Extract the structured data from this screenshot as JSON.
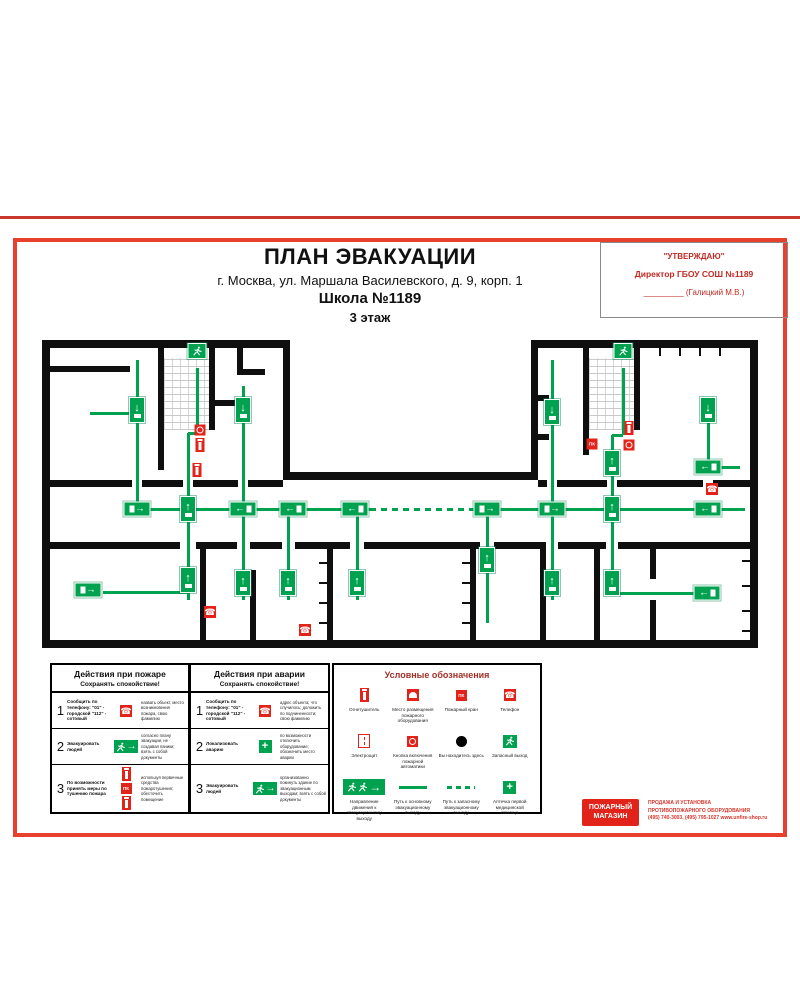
{
  "header": {
    "title": "ПЛАН ЭВАКУАЦИИ",
    "address": "г. Москва, ул. Маршала Василевского, д. 9, корп. 1",
    "building": "Школа №1189",
    "floor": "3 этаж"
  },
  "approval": {
    "line1": "\"УТВЕРЖДАЮ\"",
    "line2": "Директор ГБОУ СОШ №1189",
    "line3": "_________ (Галицкий М.В.)"
  },
  "plan": {
    "wall_color": "#0f0f0f",
    "route_color": "#00a14f",
    "alarm_color": "#e2231a",
    "walls": [
      [
        42,
        340,
        248,
        8
      ],
      [
        531,
        340,
        227,
        8
      ],
      [
        42,
        340,
        8,
        308
      ],
      [
        750,
        340,
        8,
        308
      ],
      [
        42,
        640,
        716,
        8
      ],
      [
        283,
        340,
        7,
        140
      ],
      [
        531,
        340,
        7,
        140
      ],
      [
        283,
        472,
        255,
        8
      ],
      [
        49,
        480,
        83,
        7
      ],
      [
        142,
        480,
        41,
        7
      ],
      [
        193,
        480,
        45,
        7
      ],
      [
        248,
        480,
        35,
        7
      ],
      [
        538,
        480,
        9,
        7
      ],
      [
        557,
        480,
        50,
        7
      ],
      [
        617,
        480,
        86,
        7
      ],
      [
        713,
        480,
        37,
        7
      ],
      [
        49,
        542,
        131,
        7
      ],
      [
        196,
        542,
        41,
        7
      ],
      [
        250,
        542,
        32,
        7
      ],
      [
        295,
        542,
        55,
        7
      ],
      [
        364,
        542,
        116,
        7
      ],
      [
        494,
        542,
        52,
        7
      ],
      [
        558,
        542,
        48,
        7
      ],
      [
        618,
        542,
        132,
        7
      ],
      [
        158,
        348,
        6,
        122
      ],
      [
        209,
        348,
        6,
        82
      ],
      [
        49,
        366,
        81,
        6
      ],
      [
        237,
        348,
        6,
        27
      ],
      [
        237,
        369,
        28,
        6
      ],
      [
        209,
        400,
        36,
        6
      ],
      [
        583,
        348,
        6,
        107
      ],
      [
        634,
        348,
        6,
        82
      ],
      [
        538,
        395,
        11,
        6
      ],
      [
        538,
        434,
        11,
        6
      ],
      [
        200,
        549,
        6,
        91
      ],
      [
        250,
        570,
        6,
        78
      ],
      [
        327,
        549,
        6,
        91
      ],
      [
        470,
        549,
        6,
        91
      ],
      [
        540,
        549,
        6,
        91
      ],
      [
        594,
        549,
        6,
        91
      ],
      [
        650,
        549,
        6,
        30
      ],
      [
        650,
        600,
        6,
        40
      ]
    ],
    "stairs": [
      [
        164,
        358,
        45,
        72
      ],
      [
        589,
        358,
        45,
        72
      ]
    ],
    "ticks": [
      [
        659,
        348,
        2,
        8
      ],
      [
        679,
        348,
        2,
        8
      ],
      [
        699,
        348,
        2,
        8
      ],
      [
        719,
        348,
        2,
        8
      ],
      [
        319,
        562,
        8,
        2
      ],
      [
        319,
        582,
        8,
        2
      ],
      [
        319,
        602,
        8,
        2
      ],
      [
        319,
        622,
        8,
        2
      ],
      [
        462,
        562,
        8,
        2
      ],
      [
        462,
        582,
        8,
        2
      ],
      [
        462,
        602,
        8,
        2
      ],
      [
        462,
        622,
        8,
        2
      ],
      [
        742,
        560,
        8,
        2
      ],
      [
        742,
        585,
        8,
        2
      ],
      [
        742,
        610,
        8,
        2
      ],
      [
        742,
        630,
        8,
        2
      ]
    ],
    "routes_solid": [
      [
        130,
        509,
        370,
        509
      ],
      [
        490,
        509,
        745,
        509
      ],
      [
        137,
        360,
        137,
        507
      ],
      [
        90,
        413,
        137,
        413
      ],
      [
        197,
        368,
        197,
        433
      ],
      [
        188,
        433,
        197,
        433
      ],
      [
        188,
        433,
        188,
        507
      ],
      [
        243,
        386,
        243,
        507
      ],
      [
        552,
        360,
        552,
        507
      ],
      [
        623,
        368,
        623,
        435
      ],
      [
        612,
        435,
        623,
        435
      ],
      [
        612,
        435,
        612,
        507
      ],
      [
        708,
        415,
        708,
        467
      ],
      [
        708,
        467,
        740,
        467
      ],
      [
        188,
        511,
        188,
        600
      ],
      [
        103,
        592,
        188,
        592
      ],
      [
        243,
        511,
        243,
        600
      ],
      [
        288,
        511,
        288,
        600
      ],
      [
        357,
        511,
        357,
        600
      ],
      [
        487,
        511,
        487,
        623
      ],
      [
        552,
        511,
        552,
        600
      ],
      [
        612,
        511,
        612,
        593
      ],
      [
        612,
        593,
        700,
        593
      ]
    ],
    "routes_dashed": [
      [
        370,
        509,
        490,
        509
      ]
    ],
    "badges": [
      {
        "t": "exit-right",
        "x": 137,
        "y": 509
      },
      {
        "t": "up",
        "x": 188,
        "y": 509
      },
      {
        "t": "exit-left",
        "x": 243,
        "y": 509
      },
      {
        "t": "exit-left",
        "x": 293,
        "y": 509
      },
      {
        "t": "exit-left",
        "x": 355,
        "y": 509
      },
      {
        "t": "exit-right",
        "x": 487,
        "y": 509
      },
      {
        "t": "exit-right",
        "x": 552,
        "y": 509
      },
      {
        "t": "up",
        "x": 612,
        "y": 509
      },
      {
        "t": "exit-left",
        "x": 708,
        "y": 509
      },
      {
        "t": "down",
        "x": 137,
        "y": 410
      },
      {
        "t": "down",
        "x": 243,
        "y": 410
      },
      {
        "t": "down",
        "x": 552,
        "y": 412
      },
      {
        "t": "down",
        "x": 708,
        "y": 410
      },
      {
        "t": "up",
        "x": 612,
        "y": 463
      },
      {
        "t": "exit-left",
        "x": 708,
        "y": 467
      },
      {
        "t": "runner",
        "x": 197,
        "y": 351
      },
      {
        "t": "runner",
        "x": 623,
        "y": 351
      },
      {
        "t": "ah",
        "x": 197,
        "y": 371
      },
      {
        "t": "ah",
        "x": 623,
        "y": 371
      },
      {
        "t": "exit-right",
        "x": 88,
        "y": 590
      },
      {
        "t": "up",
        "x": 188,
        "y": 580
      },
      {
        "t": "up",
        "x": 243,
        "y": 583
      },
      {
        "t": "up",
        "x": 288,
        "y": 583
      },
      {
        "t": "up",
        "x": 357,
        "y": 583
      },
      {
        "t": "up",
        "x": 487,
        "y": 560
      },
      {
        "t": "up",
        "x": 552,
        "y": 583
      },
      {
        "t": "up",
        "x": 612,
        "y": 583
      },
      {
        "t": "exit-left",
        "x": 707,
        "y": 593
      }
    ],
    "icons": [
      {
        "t": "call",
        "x": 200,
        "y": 430
      },
      {
        "t": "ext",
        "x": 200,
        "y": 445
      },
      {
        "t": "ext",
        "x": 197,
        "y": 470
      },
      {
        "t": "ext",
        "x": 629,
        "y": 428
      },
      {
        "t": "call",
        "x": 629,
        "y": 445
      },
      {
        "t": "crane",
        "x": 592,
        "y": 444
      },
      {
        "t": "phone",
        "x": 712,
        "y": 489
      },
      {
        "t": "phone",
        "x": 210,
        "y": 612
      },
      {
        "t": "phone",
        "x": 305,
        "y": 630
      }
    ]
  },
  "legend_fire": {
    "title": "Действия при пожаре",
    "subtitle": "Сохранять спокойствие!",
    "rows": [
      {
        "num": "1",
        "action": "Сообщить по телефону: \"01\" - городской \"112\" - сотовый",
        "icon": "phone",
        "note": "назвать объект, место возникновения пожара, свою фамилию"
      },
      {
        "num": "2",
        "action": "Эвакуировать людей",
        "icon": "exitsign",
        "note": "согласно плану эвакуации, не создавая паники; взять с собой документы"
      },
      {
        "num": "3",
        "action": "По возможности принять меры по тушению пожара",
        "icon": "fire-equip",
        "note": "используя первичные средства пожаротушения; обесточить помещение"
      }
    ]
  },
  "legend_accident": {
    "title": "Действия при аварии",
    "subtitle": "Сохранять спокойствие!",
    "rows": [
      {
        "num": "1",
        "action": "Сообщить по телефону: \"01\" - городской \"112\" - сотовый",
        "icon": "phone",
        "note": "адрес объекта; что случилось; доложить по подчиненности; свою фамилию"
      },
      {
        "num": "2",
        "action": "Локализовать аварию",
        "icon": "cross",
        "note": "по возможности отключить оборудование; обозначить место аварии"
      },
      {
        "num": "3",
        "action": "Эвакуировать людей",
        "icon": "exitsign",
        "note": "организованно покинуть здание по эвакуационным выходам; взять с собой документы"
      }
    ]
  },
  "legend_symbols": {
    "title": "Условные обозначения",
    "items": [
      {
        "t": "ext",
        "label": "Огнетушитель"
      },
      {
        "t": "place",
        "label": "Место размещения пожарного оборудования"
      },
      {
        "t": "crane",
        "label": "Пожарный кран"
      },
      {
        "t": "phone",
        "label": "Телефон"
      },
      {
        "t": "panel",
        "label": "Электрощит"
      },
      {
        "t": "call",
        "label": "Кнопка включения пожарной автоматики"
      },
      {
        "t": "here",
        "label": "Вы находитесь здесь"
      },
      {
        "t": "runbox",
        "label": "Запасный выход"
      },
      {
        "t": "dir",
        "label": "Направление движения к эвакуационному выходу"
      },
      {
        "t": "sline",
        "label": "Путь к основному эвакуационному выходу"
      },
      {
        "t": "dline",
        "label": "Путь к запасному эвакуационному выходу"
      },
      {
        "t": "cross",
        "label": "Аптечка первой медицинской помощи"
      }
    ]
  },
  "footer": {
    "shop_line1": "ПОЖАРНЫЙ",
    "shop_line2": "МАГАЗИН",
    "sales_line1": "ПРОДАЖА И УСТАНОВКА",
    "sales_line2": "ПРОТИВОПОЖАРНОГО ОБОРУДОВАНИЯ",
    "sales_line3": "(495) 740-3003, (495) 795-1027 www.unfire-shop.ru"
  }
}
